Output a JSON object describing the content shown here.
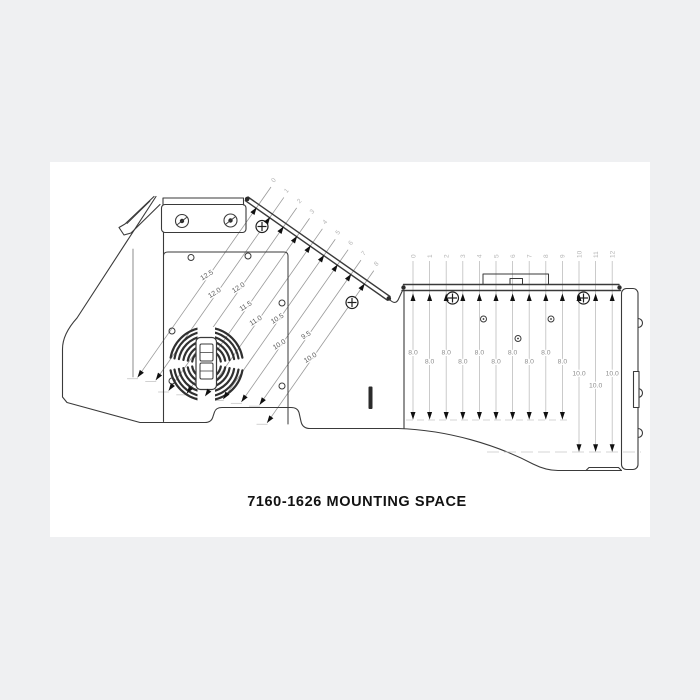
{
  "sheet": {
    "background": "#eff0f2",
    "paper": "#ffffff"
  },
  "caption": "7160-1626 MOUNTING SPACE",
  "left_view": {
    "ticks": [
      "0",
      "1",
      "2",
      "3",
      "4",
      "5",
      "6",
      "7",
      "8"
    ],
    "values": [
      "12.5",
      "12.0",
      "12.0",
      "11.5",
      "11.0",
      "10.5",
      "10.0",
      "9.5",
      "10.0"
    ]
  },
  "right_view": {
    "ticks": [
      "0",
      "1",
      "2",
      "3",
      "4",
      "5",
      "6",
      "7",
      "8",
      "9",
      "10",
      "11",
      "12"
    ],
    "values": [
      "8.0",
      "8.0",
      "8.0",
      "8.0",
      "8.0",
      "8.0",
      "8.0",
      "8.0",
      "8.0",
      "8.0",
      "10.0",
      "10.0",
      "10.0"
    ]
  },
  "colors": {
    "outline": "#3a3a3a",
    "dim_line": "#9a9a9a",
    "dim_line_light": "#bdbdbd",
    "dim_text": "#5c5c5c",
    "dim_text_light": "#8c8c8c",
    "tick_label": "#b5b5b5",
    "arrow": "#101010"
  }
}
